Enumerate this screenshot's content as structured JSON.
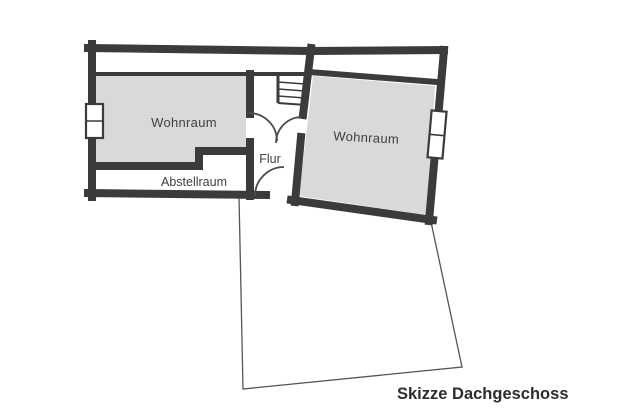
{
  "colors": {
    "wall": "#3b3b3b",
    "room_fill": "#d9d9d9",
    "thin_line": "#555555",
    "door_arc": "#4a4a4a",
    "background": "#ffffff",
    "text": "#3f3f3f"
  },
  "rooms": {
    "wohnraum_left": {
      "label": "Wohnraum"
    },
    "wohnraum_right": {
      "label": "Wohnraum"
    },
    "flur": {
      "label": "Flur"
    },
    "abstellraum": {
      "label": "Abstellraum"
    }
  },
  "caption": {
    "text": "Skizze Dachgeschoss"
  }
}
